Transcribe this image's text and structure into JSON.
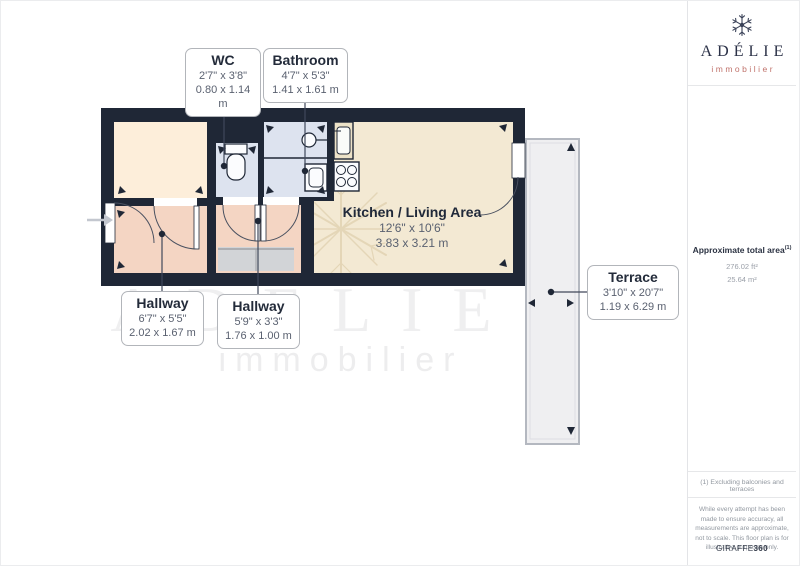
{
  "branding": {
    "name": "ADÉLIE",
    "tagline": "immobilier",
    "watermark_name": "ADÉLIE",
    "watermark_tagline": "immobilier",
    "provider": "GIRAFFE",
    "provider_suffix": "360"
  },
  "rooms": {
    "wc": {
      "name": "WC",
      "imperial": "2'7\" x 3'8\"",
      "metric": "0.80 x 1.14 m"
    },
    "bathroom": {
      "name": "Bathroom",
      "imperial": "4'7\" x 5'3\"",
      "metric": "1.41 x 1.61 m"
    },
    "kitchen_living": {
      "name": "Kitchen / Living Area",
      "imperial": "12'6\" x 10'6\"",
      "metric": "3.83 x 3.21 m"
    },
    "hallway_left": {
      "name": "Hallway",
      "imperial": "6'7\" x 5'5\"",
      "metric": "2.02 x 1.67 m"
    },
    "hallway_middle": {
      "name": "Hallway",
      "imperial": "5'9\" x 3'3\"",
      "metric": "1.76 x 1.00 m"
    },
    "terrace": {
      "name": "Terrace",
      "imperial": "3'10\" x 20'7\"",
      "metric": "1.19 x 6.29 m"
    }
  },
  "panel": {
    "total_area_label": "Approximate total area",
    "total_area_sup": "(1)",
    "total_area_ft": "276.02 ft²",
    "total_area_m": "25.64 m²",
    "footnote": "(1) Excluding balconies and terraces",
    "disclaimer": "While every attempt has been made to ensure accuracy, all measurements are approximate, not to scale. This floor plan is for illustrative purposes only."
  },
  "colors": {
    "wall": "#1f2736",
    "kitchen_floor": "#f3e9d3",
    "hallway_floor": "#f4d5c3",
    "bathroom_floor": "#dde3ef",
    "room_floor": "#fdeeda",
    "closet_floor": "#d2d4d7",
    "terrace_floor": "#efeff1",
    "brand_navy": "#2b3147",
    "brand_coral": "#c0726b"
  }
}
